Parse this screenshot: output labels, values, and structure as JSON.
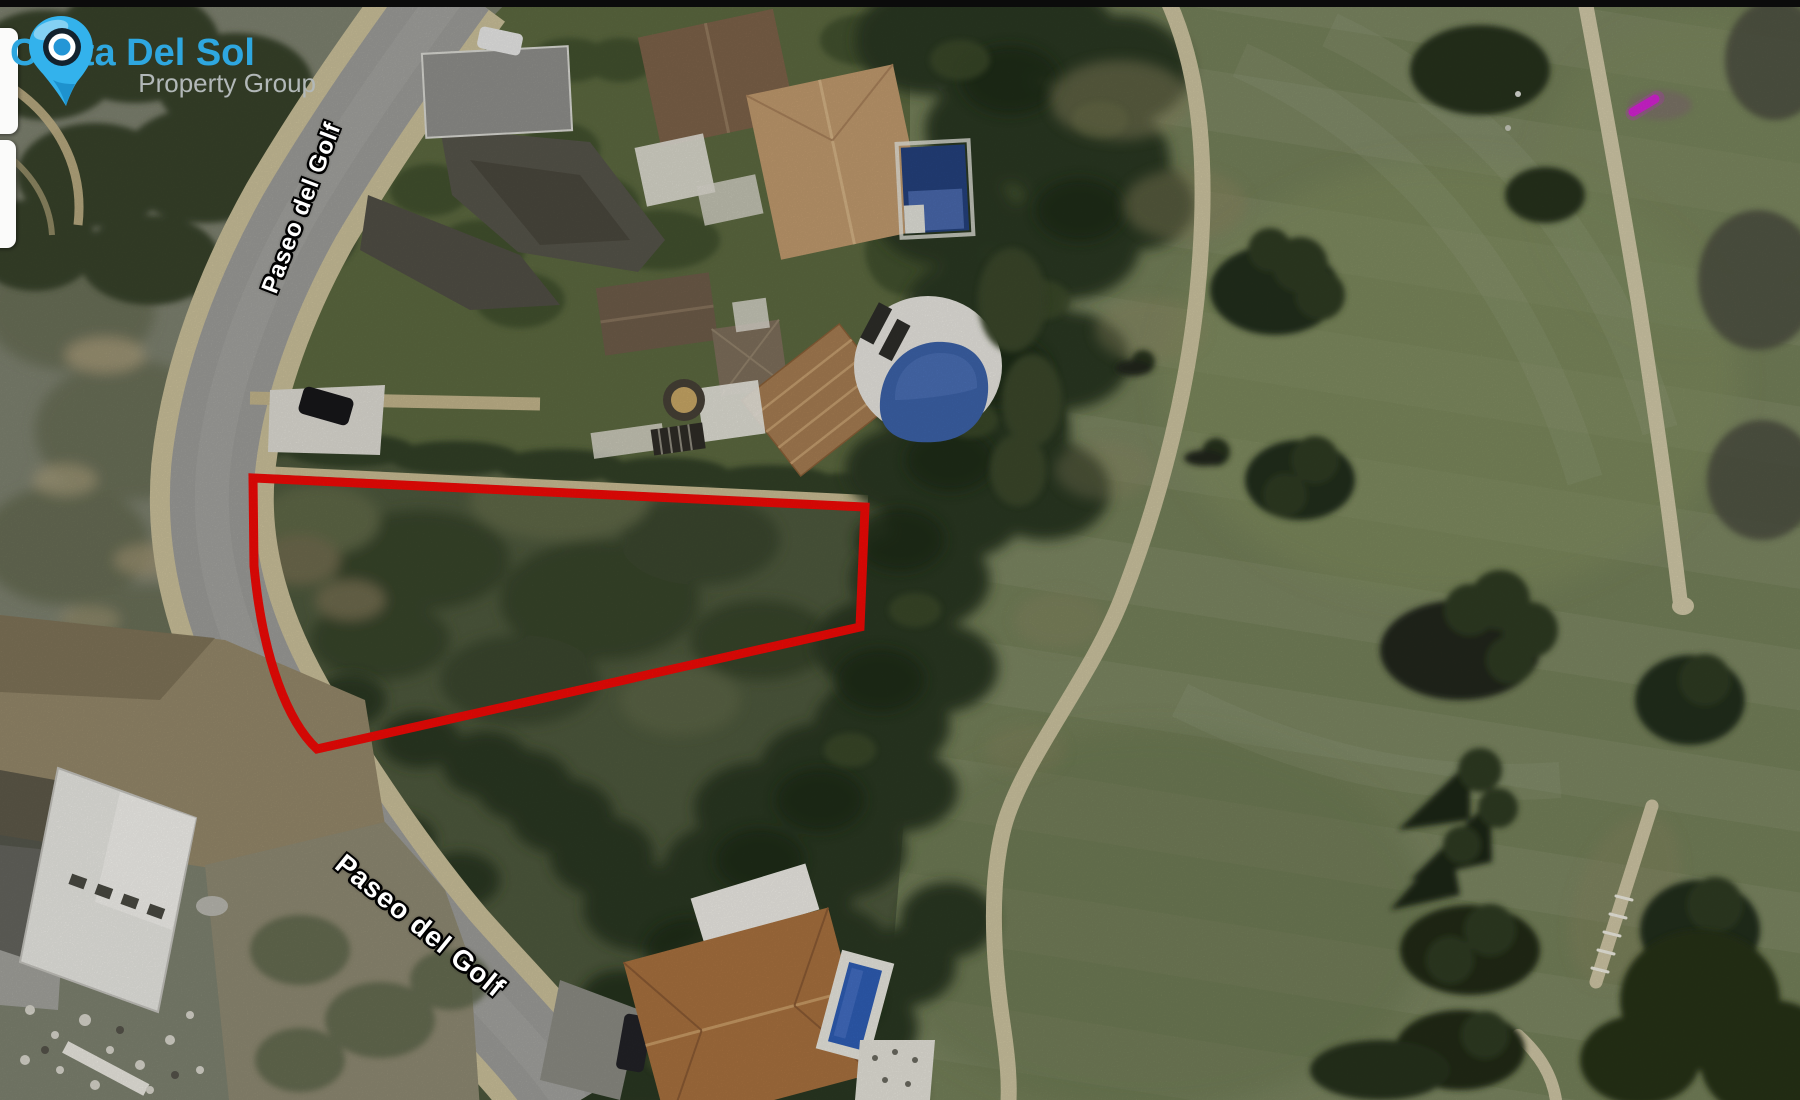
{
  "branding": {
    "title": "Costa Del Sol",
    "subtitle": "Property Group",
    "title_color": "#2ea7e0",
    "subtitle_color": "#b2b8b8",
    "pin_color": "#33b2ec"
  },
  "map": {
    "view": "satellite",
    "road_labels": [
      {
        "text": "Paseo del Golf"
      },
      {
        "text": "Paseo del Golf"
      }
    ],
    "plot_outline_color": "#f20a06"
  }
}
